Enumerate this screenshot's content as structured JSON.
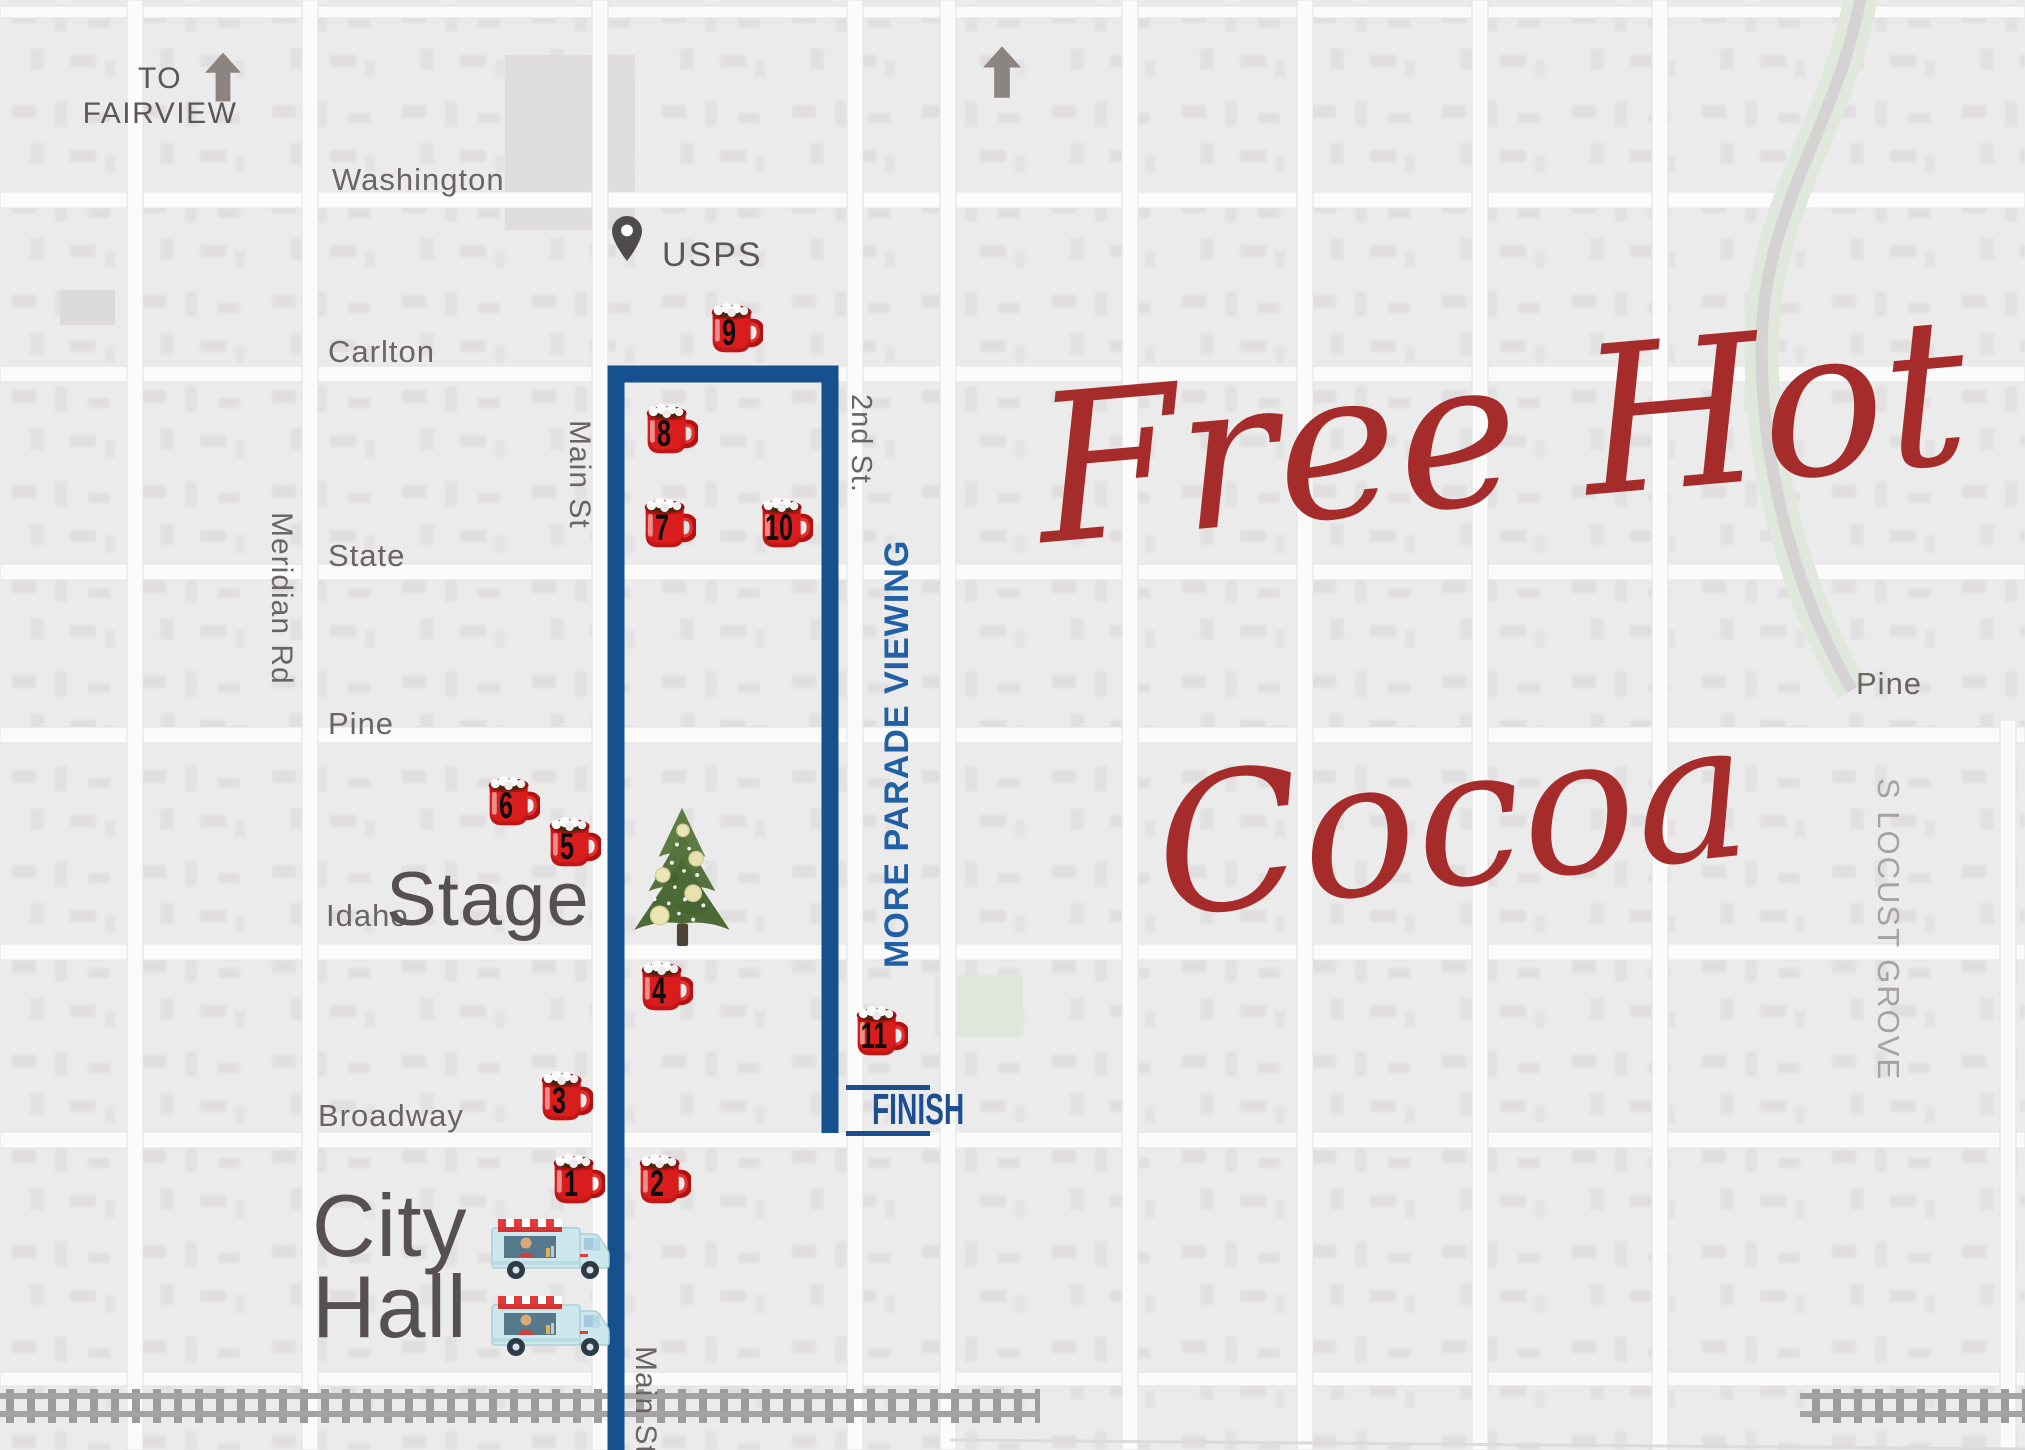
{
  "title": {
    "line1": "Free Hot",
    "line2": "Cocoa"
  },
  "north": {
    "to_line1": "TO",
    "to_line2": "FAIRVIEW"
  },
  "landmarks": {
    "usps": "USPS",
    "stage": "Stage",
    "city_hall_line1": "City",
    "city_hall_line2": "Hall",
    "finish": "FINISH",
    "more_parade_viewing": "MORE PARADE VIEWING"
  },
  "streets": {
    "washington": "Washington",
    "carlton": "Carlton",
    "state": "State",
    "pine_west": "Pine",
    "idaho": "Idaho",
    "broadway": "Broadway",
    "meridian_rd": "Meridian Rd",
    "main_st_north": "Main St",
    "second_st": "2nd St.",
    "main_st_south": "Main St",
    "pine_east": "Pine",
    "s_locust_grove": "S LOCUST GROVE"
  },
  "stations": [
    "1",
    "2",
    "3",
    "4",
    "5",
    "6",
    "7",
    "8",
    "9",
    "10",
    "11"
  ],
  "colors": {
    "map_background": "#ecebeb",
    "street_white": "#fbfbfb",
    "route_blue": "#16508f",
    "viewing_text_blue": "#2160a6",
    "finish_blue": "#1c4f92",
    "mug_red": "#d91d1d",
    "script_red": "#a52c2a",
    "label_gray": "#5d5656",
    "street_label_gray": "#6b6464",
    "light_label_gray": "#a7a1a1",
    "tree_green": "#4c6a36",
    "truck_teal": "#cde8ec",
    "arrow_gray": "#8b8481",
    "rail_gray": "#9c9c9c"
  }
}
